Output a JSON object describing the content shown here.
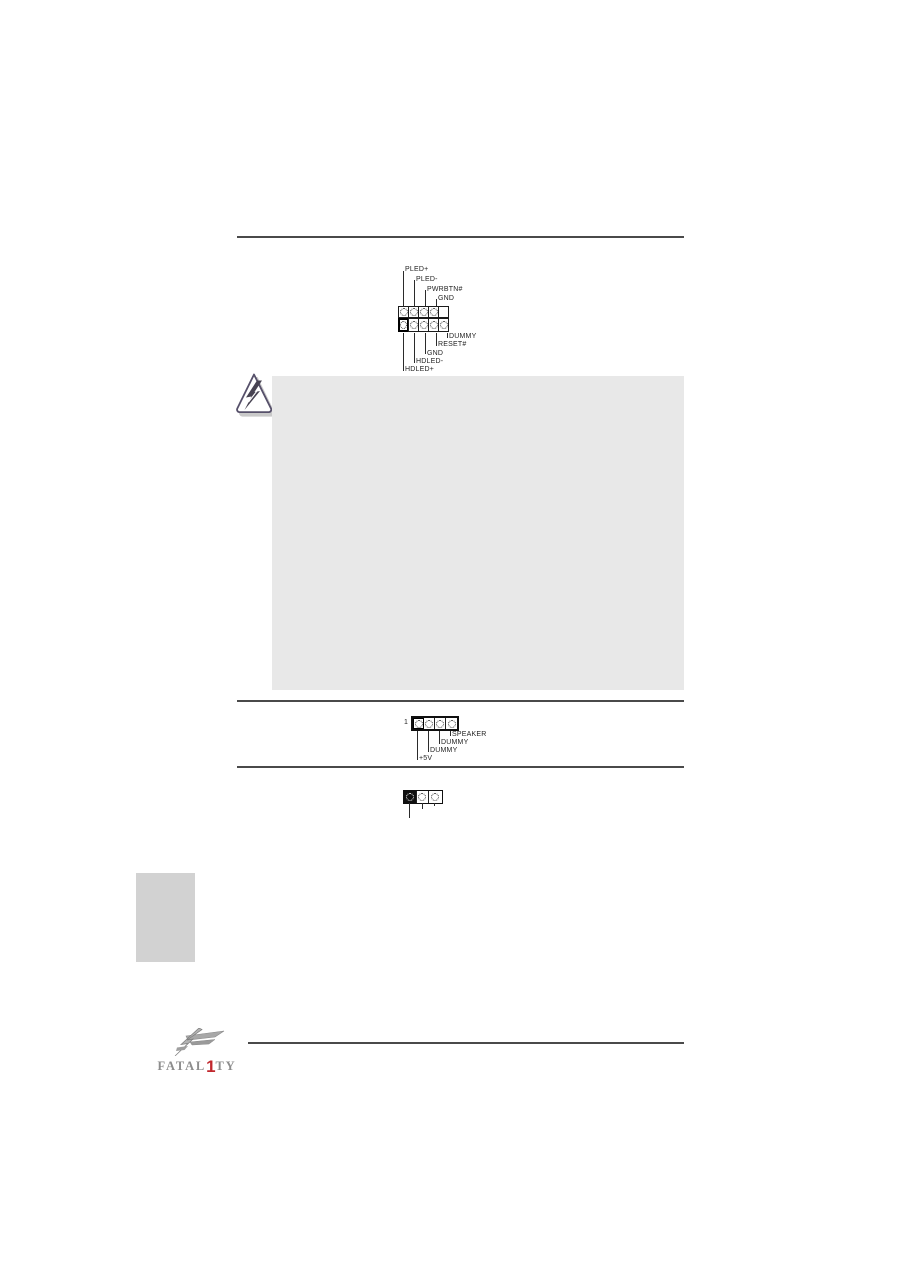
{
  "panel_header_diagram": {
    "top_pin_labels": [
      "PLED+",
      "PLED-",
      "PWRBTN#",
      "GND"
    ],
    "bottom_pin_labels": [
      "DUMMY",
      "RESET#",
      "GND",
      "HDLED-",
      "HDLED+"
    ]
  },
  "speaker_header_diagram": {
    "pin_number": "1",
    "pin_labels": [
      "SPEAKER",
      "DUMMY",
      "DUMMY",
      "+5V"
    ]
  },
  "logo": {
    "pre": "FATAL",
    "one": "1",
    "post": "TY"
  },
  "colors": {
    "rule": "#4a4a4a",
    "caution_box_bg": "#e8e8e8",
    "sidebar_tab_bg": "#d2d2d2",
    "logo_red": "#c1272d",
    "logo_gray": "#8d8d8d"
  },
  "icons": {
    "warning": "warning-lightning-icon",
    "logo_emblem": "fatality-emblem-icon"
  }
}
